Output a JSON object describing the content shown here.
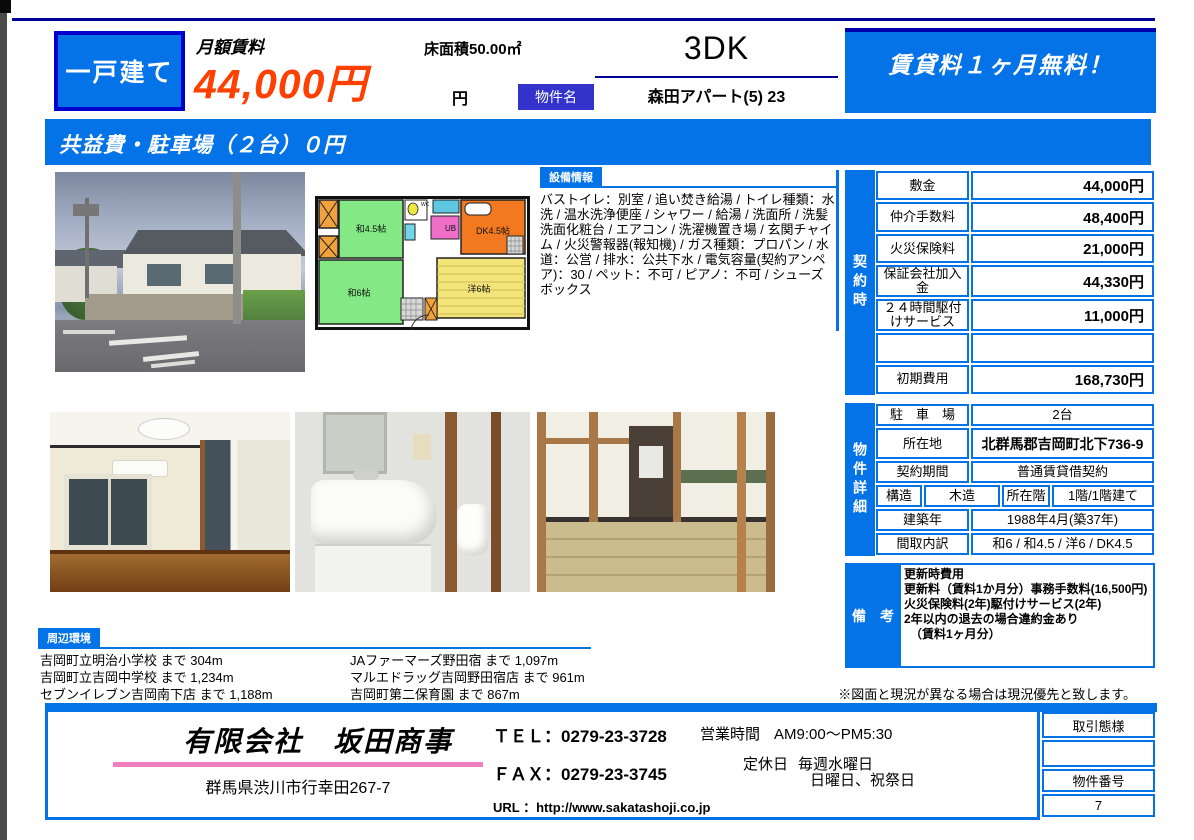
{
  "header": {
    "type_badge": "一戸建て",
    "rent_label": "月額賃料",
    "rent_value": "44,000円",
    "floor_area": "床面積50.00㎡",
    "yen_suffix": "円",
    "name_label": "物件名",
    "layout": "3DK",
    "property_name": "森田アパート(5) 23",
    "campaign": "賃貸料１ヶ月無料！"
  },
  "banner": "共益費・駐車場（２台）０円",
  "equipment": {
    "label": "設備情報",
    "text": "バストイレ：別室 / 追い焚き給湯 / トイレ種類：水洗 / 温水洗浄便座 / シャワー / 給湯 / 洗面所 / 洗髪洗面化粧台 / エアコン / 洗濯機置き場 / 玄関チャイム / 火災警報器(報知機) / ガス種類：プロパン / 水道：公営 / 排水：公共下水 / 電気容量(契約アンペア)：30 / ペット：不可 / ピアノ：不可 / シューズボックス"
  },
  "contract": {
    "sidebar": "契約時",
    "rows": [
      {
        "label": "敷金",
        "value": "44,000円"
      },
      {
        "label": "仲介手数料",
        "value": "48,400円"
      },
      {
        "label": "火災保険料",
        "value": "21,000円"
      },
      {
        "label": "保証会社加入金",
        "value": "44,330円"
      },
      {
        "label": "２４時間駆付けサービス",
        "value": "11,000円"
      },
      {
        "label": "",
        "value": ""
      },
      {
        "label": "初期費用",
        "value": "168,730円"
      }
    ]
  },
  "details": {
    "sidebar": "物件詳細",
    "parking_label": "駐　車　場",
    "parking_value": "2台",
    "location_label": "所在地",
    "location_value": "北群馬郡吉岡町北下736-9",
    "period_label": "契約期間",
    "period_value": "普通賃貸借契約",
    "structure_label": "構造",
    "structure_value": "木造",
    "floor_label": "所在階",
    "floor_value": "1階/1階建て",
    "built_label": "建築年",
    "built_value": "1988年4月(築37年)",
    "madori_label": "間取内訳",
    "madori_value": "和6 / 和4.5 / 洋6 / DK4.5"
  },
  "remarks": {
    "label": "備　考",
    "lines": [
      "更新時費用",
      "更新料（賃料1か月分）事務手数料(16,500円)",
      "火災保険料(2年)駆付けサービス(2年)",
      "2年以内の退去の場合違約金あり",
      "（賃料1ヶ月分）"
    ]
  },
  "note": "※図面と現況が異なる場合は現況優先と致します。",
  "neighborhood": {
    "label": "周辺環境",
    "col1": [
      "吉岡町立明治小学校 まで 304m",
      "吉岡町立吉岡中学校 まで 1,234m",
      "セブンイレブン吉岡南下店 まで 1,188m"
    ],
    "col2": [
      "JAファーマーズ野田宿 まで 1,097m",
      "マルエドラッグ吉岡野田宿店 まで 961m",
      "吉岡町第二保育園 まで 867m"
    ]
  },
  "floorplan": {
    "room_wa45": "和4.5帖",
    "room_wa6": "和6帖",
    "room_dk": "DK4.5帖",
    "room_yo6": "洋6帖",
    "room_ub": "UB",
    "room_wc": "WC"
  },
  "footer": {
    "company": "有限会社　坂田商事",
    "address": "群馬県渋川市行幸田267-7",
    "tel_label": "ＴＥＬ：",
    "tel": "0279-23-3728",
    "fax_label": "ＦＡＸ：",
    "fax": "0279-23-3745",
    "url_label": "URL ：",
    "url": "http://www.sakatashoji.co.jp",
    "hours_label": "営業時間",
    "hours": "AM9:00～PM5:30",
    "closed_label": "定休日",
    "closed_value1": "毎週水曜日",
    "closed_value2": "日曜日、祝祭日",
    "deal_type_label": "取引態様",
    "deal_type_value": "",
    "property_no_label": "物件番号",
    "property_no": "7"
  },
  "colors": {
    "accent_blue": "#0573e8",
    "navy": "#000099",
    "label_purple": "#3333cc",
    "price_orange": "#ff4000",
    "pink": "#f07fc0"
  }
}
